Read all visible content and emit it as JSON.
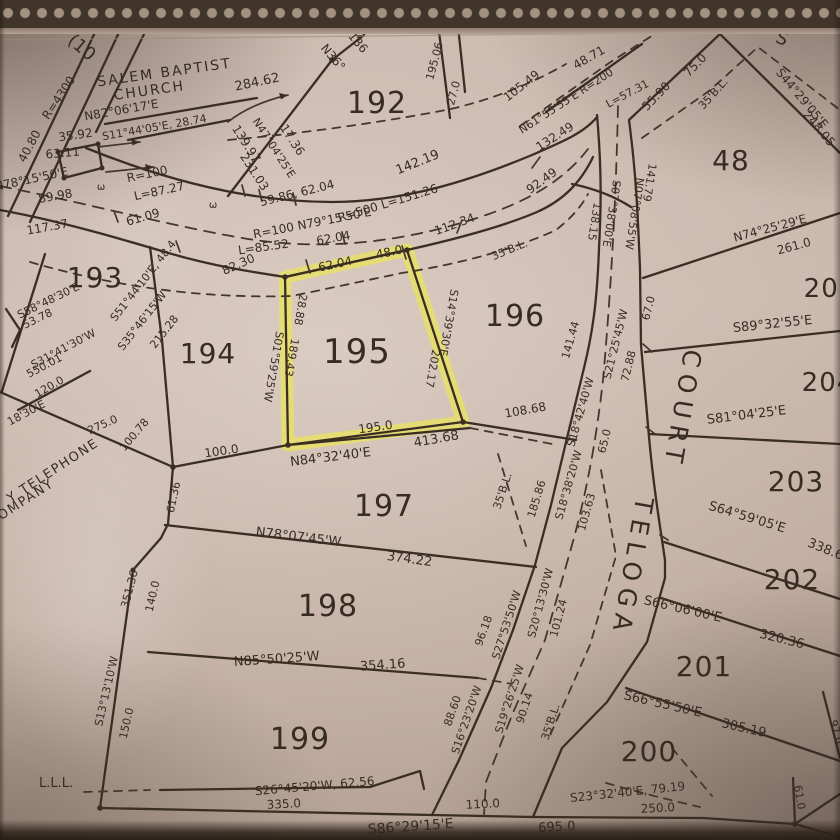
{
  "colors": {
    "ink": "#3a2e23",
    "highlight": "#e9e164",
    "paper": "#c9b6ab"
  },
  "map": {
    "street_name": "TELOGA COURT",
    "landmark": "SALEM BAPTIST CHURCH",
    "highlighted_lot": "195",
    "lot_numbers": [
      "48",
      "192",
      "193",
      "194",
      "195",
      "196",
      "197",
      "198",
      "199",
      "200",
      "201",
      "202",
      "203",
      "204",
      "205"
    ],
    "highlight_polygon": "285,277 407,250 463,422 288,445",
    "labels": [
      {
        "t": "(10",
        "x": 78,
        "y": 52,
        "r": 40,
        "s": 18
      },
      {
        "t": "R=4300",
        "x": 62,
        "y": 100,
        "r": -56,
        "s": 12
      },
      {
        "t": "SALEM BAPTIST",
        "x": 165,
        "y": 77,
        "r": -8,
        "s": 14,
        "sp": 2,
        "n": "church-label"
      },
      {
        "t": "CHURCH",
        "x": 150,
        "y": 95,
        "r": -8,
        "s": 14,
        "sp": 2,
        "n": "church-label"
      },
      {
        "t": "284.62",
        "x": 258,
        "y": 86,
        "r": -12,
        "s": 13
      },
      {
        "t": "N82°06'17'E",
        "x": 122,
        "y": 114,
        "r": -10,
        "s": 12
      },
      {
        "t": "S11°44'05'E, 28.74",
        "x": 155,
        "y": 131,
        "r": -10,
        "s": 11
      },
      {
        "t": "40.80",
        "x": 33,
        "y": 148,
        "r": -62,
        "s": 12
      },
      {
        "t": "35.92",
        "x": 76,
        "y": 139,
        "r": -8,
        "s": 12
      },
      {
        "t": "63.11",
        "x": 63,
        "y": 157,
        "r": -5,
        "s": 12
      },
      {
        "t": "N78°15'50'E",
        "x": 32,
        "y": 183,
        "r": -12,
        "s": 12
      },
      {
        "t": "89.98",
        "x": 56,
        "y": 200,
        "r": -10,
        "s": 12
      },
      {
        "t": "ω",
        "x": 101,
        "y": 190,
        "r": 0,
        "s": 10
      },
      {
        "t": "ω",
        "x": 213,
        "y": 208,
        "r": 0,
        "s": 10
      },
      {
        "t": "R=100",
        "x": 148,
        "y": 178,
        "r": -12,
        "s": 12
      },
      {
        "t": "L=87.27",
        "x": 160,
        "y": 195,
        "r": -12,
        "s": 12
      },
      {
        "t": "117.37",
        "x": 48,
        "y": 231,
        "r": -10,
        "s": 12
      },
      {
        "t": "61.09",
        "x": 144,
        "y": 221,
        "r": -16,
        "s": 12
      },
      {
        "t": "139.97",
        "x": 243,
        "y": 146,
        "r": 57,
        "s": 12
      },
      {
        "t": "N47°04'25'E",
        "x": 271,
        "y": 150,
        "r": 57,
        "s": 11
      },
      {
        "t": "231.03",
        "x": 251,
        "y": 174,
        "r": 57,
        "s": 12
      },
      {
        "t": "17.36",
        "x": 289,
        "y": 142,
        "r": 57,
        "s": 12
      },
      {
        "t": "N36°",
        "x": 330,
        "y": 60,
        "r": 50,
        "s": 12
      },
      {
        "t": "136",
        "x": 355,
        "y": 45,
        "r": 50,
        "s": 12
      },
      {
        "t": "192",
        "x": 377,
        "y": 113,
        "r": 0,
        "s": 30,
        "cls": "lot",
        "n": "lot-number-192"
      },
      {
        "t": "59.86, 62.04",
        "x": 298,
        "y": 197,
        "r": -14,
        "s": 12
      },
      {
        "t": "R=100 N79°15'50'E",
        "x": 313,
        "y": 227,
        "r": -11,
        "s": 12
      },
      {
        "t": "62.04",
        "x": 334,
        "y": 242,
        "r": -10,
        "s": 12
      },
      {
        "t": "L=85.52",
        "x": 264,
        "y": 251,
        "r": -8,
        "s": 12
      },
      {
        "t": "142.19",
        "x": 419,
        "y": 166,
        "r": -22,
        "s": 13
      },
      {
        "t": "R=500 L=151.26",
        "x": 389,
        "y": 207,
        "r": -17,
        "s": 12
      },
      {
        "t": "112.34",
        "x": 456,
        "y": 228,
        "r": -20,
        "s": 12
      },
      {
        "t": "62.04",
        "x": 336,
        "y": 268,
        "r": -12,
        "s": 12
      },
      {
        "t": "48.0",
        "x": 390,
        "y": 256,
        "r": -12,
        "s": 12
      },
      {
        "t": "82.30",
        "x": 240,
        "y": 268,
        "r": -24,
        "s": 12
      },
      {
        "t": "195.06",
        "x": 438,
        "y": 62,
        "r": -75,
        "s": 11
      },
      {
        "t": "27.0",
        "x": 457,
        "y": 94,
        "r": -75,
        "s": 11
      },
      {
        "t": "105.49",
        "x": 524,
        "y": 89,
        "r": -38,
        "s": 12
      },
      {
        "t": "48.71",
        "x": 591,
        "y": 61,
        "r": -30,
        "s": 12
      },
      {
        "t": "N61°55'55'E R=200",
        "x": 568,
        "y": 104,
        "r": -33,
        "s": 11
      },
      {
        "t": "L=57.31",
        "x": 629,
        "y": 97,
        "r": -28,
        "s": 11
      },
      {
        "t": "132.49",
        "x": 557,
        "y": 140,
        "r": -33,
        "s": 12
      },
      {
        "t": "92.49",
        "x": 544,
        "y": 184,
        "r": -36,
        "s": 12
      },
      {
        "t": "S",
        "x": 780,
        "y": 44,
        "r": 20,
        "s": 18
      },
      {
        "t": "55.90",
        "x": 659,
        "y": 99,
        "r": -46,
        "s": 12
      },
      {
        "t": "75.0",
        "x": 698,
        "y": 68,
        "r": -46,
        "s": 12
      },
      {
        "t": "35'B.L.",
        "x": 716,
        "y": 96,
        "r": -48,
        "s": 11
      },
      {
        "t": "S44°29'05'E",
        "x": 799,
        "y": 101,
        "r": 50,
        "s": 12
      },
      {
        "t": "248.05",
        "x": 816,
        "y": 131,
        "r": 50,
        "s": 12
      },
      {
        "t": "48",
        "x": 731,
        "y": 170,
        "r": 0,
        "s": 28,
        "cls": "lot",
        "n": "lot-number-48"
      },
      {
        "t": "N74°25'29'E",
        "x": 771,
        "y": 232,
        "r": -15,
        "s": 12
      },
      {
        "t": "261.0",
        "x": 795,
        "y": 250,
        "r": -15,
        "s": 12
      },
      {
        "t": "141.79",
        "x": 646,
        "y": 182,
        "r": 99,
        "s": 11
      },
      {
        "t": "N07°08'55'W",
        "x": 631,
        "y": 213,
        "r": 99,
        "s": 11
      },
      {
        "t": "138.15",
        "x": 591,
        "y": 221,
        "r": 99,
        "s": 11
      },
      {
        "t": "S07°38'00'E",
        "x": 608,
        "y": 213,
        "r": 99,
        "s": 11
      },
      {
        "t": "196",
        "x": 515,
        "y": 326,
        "r": 0,
        "s": 30,
        "cls": "lot",
        "n": "lot-number-196"
      },
      {
        "t": "35'B.L.",
        "x": 511,
        "y": 253,
        "r": -22,
        "s": 11
      },
      {
        "t": "S14°39'30'E",
        "x": 445,
        "y": 322,
        "r": 100,
        "s": 11
      },
      {
        "t": "202.17",
        "x": 429,
        "y": 368,
        "r": 100,
        "s": 11
      },
      {
        "t": "195",
        "x": 357,
        "y": 363,
        "r": 0,
        "s": 34,
        "cls": "lot",
        "n": "lot-number-195"
      },
      {
        "t": "S01°59'25'W",
        "x": 270,
        "y": 366,
        "r": 100,
        "s": 11
      },
      {
        "t": "189.43",
        "x": 288,
        "y": 357,
        "r": 100,
        "s": 11
      },
      {
        "t": "28.88",
        "x": 297,
        "y": 309,
        "r": 100,
        "s": 11
      },
      {
        "t": "195.0",
        "x": 376,
        "y": 431,
        "r": -8,
        "s": 12
      },
      {
        "t": "N84°32'40'E",
        "x": 331,
        "y": 461,
        "r": -7,
        "s": 13
      },
      {
        "t": "413.68",
        "x": 437,
        "y": 443,
        "r": -10,
        "s": 13
      },
      {
        "t": "108.68",
        "x": 526,
        "y": 414,
        "r": -10,
        "s": 12
      },
      {
        "t": "193",
        "x": 95,
        "y": 287,
        "r": 0,
        "s": 28,
        "cls": "lot",
        "n": "lot-number-193"
      },
      {
        "t": "S58°48'30'E",
        "x": 50,
        "y": 304,
        "r": -26,
        "s": 11
      },
      {
        "t": "53.78",
        "x": 39,
        "y": 322,
        "r": -26,
        "s": 11
      },
      {
        "t": "S31°41'30'W",
        "x": 65,
        "y": 352,
        "r": -28,
        "s": 11
      },
      {
        "t": "550.01",
        "x": 46,
        "y": 369,
        "r": -28,
        "s": 11
      },
      {
        "t": "120.0",
        "x": 51,
        "y": 390,
        "r": -30,
        "s": 11
      },
      {
        "t": "18'30'E",
        "x": 28,
        "y": 416,
        "r": -28,
        "s": 11
      },
      {
        "t": "275.0",
        "x": 104,
        "y": 428,
        "r": -24,
        "s": 11
      },
      {
        "t": "Y TELEPHONE",
        "x": 55,
        "y": 474,
        "r": -33,
        "s": 13,
        "sp": 1.5
      },
      {
        "t": "OMPANY",
        "x": 28,
        "y": 503,
        "r": -33,
        "s": 13,
        "sp": 1.5
      },
      {
        "t": "100.78",
        "x": 137,
        "y": 437,
        "r": -50,
        "s": 11
      },
      {
        "t": "100.0",
        "x": 222,
        "y": 455,
        "r": -8,
        "s": 12
      },
      {
        "t": "S51°44'10'E, 48.4",
        "x": 146,
        "y": 283,
        "r": -52,
        "s": 11
      },
      {
        "t": "S35°46'15'W",
        "x": 145,
        "y": 323,
        "r": -52,
        "s": 11
      },
      {
        "t": "215.28",
        "x": 167,
        "y": 334,
        "r": -52,
        "s": 11
      },
      {
        "t": "194",
        "x": 208,
        "y": 363,
        "r": 0,
        "s": 28,
        "cls": "lot",
        "n": "lot-number-194"
      },
      {
        "t": "61.36",
        "x": 177,
        "y": 498,
        "r": -78,
        "s": 11
      },
      {
        "t": "351.36",
        "x": 133,
        "y": 590,
        "r": -75,
        "s": 11
      },
      {
        "t": "140.0",
        "x": 156,
        "y": 597,
        "r": -77,
        "s": 11
      },
      {
        "t": "S13°13'10'W",
        "x": 110,
        "y": 692,
        "r": -77,
        "s": 11
      },
      {
        "t": "150.0",
        "x": 130,
        "y": 724,
        "r": -77,
        "s": 11
      },
      {
        "t": "L.L.L.",
        "x": 56,
        "y": 787,
        "r": 0,
        "s": 13
      },
      {
        "t": "197",
        "x": 384,
        "y": 516,
        "r": 0,
        "s": 30,
        "cls": "lot",
        "n": "lot-number-197"
      },
      {
        "t": "N78°07'45'W",
        "x": 298,
        "y": 541,
        "r": 7,
        "s": 13
      },
      {
        "t": "374.22",
        "x": 409,
        "y": 563,
        "r": 8,
        "s": 13
      },
      {
        "t": "198",
        "x": 328,
        "y": 616,
        "r": 0,
        "s": 30,
        "cls": "lot",
        "n": "lot-number-198"
      },
      {
        "t": "N85°50'25'W",
        "x": 277,
        "y": 663,
        "r": -4,
        "s": 13
      },
      {
        "t": "354.16",
        "x": 383,
        "y": 669,
        "r": -4,
        "s": 13
      },
      {
        "t": "199",
        "x": 300,
        "y": 749,
        "r": 0,
        "s": 30,
        "cls": "lot",
        "n": "lot-number-199"
      },
      {
        "t": "S26°45'20'W, 62.56",
        "x": 315,
        "y": 790,
        "r": -5,
        "s": 12
      },
      {
        "t": "335.0",
        "x": 284,
        "y": 808,
        "r": -3,
        "s": 12
      },
      {
        "t": "35'B.L.",
        "x": 506,
        "y": 492,
        "r": -72,
        "s": 11
      },
      {
        "t": "96.18",
        "x": 487,
        "y": 632,
        "r": -70,
        "s": 11
      },
      {
        "t": "S27°53'50'W",
        "x": 510,
        "y": 626,
        "r": -72,
        "s": 11
      },
      {
        "t": "S20°13'30'W",
        "x": 544,
        "y": 604,
        "r": -75,
        "s": 11
      },
      {
        "t": "101.24",
        "x": 562,
        "y": 619,
        "r": -75,
        "s": 11
      },
      {
        "t": "S19°26'25'W",
        "x": 513,
        "y": 700,
        "r": -72,
        "s": 11
      },
      {
        "t": "90.14",
        "x": 528,
        "y": 709,
        "r": -72,
        "s": 11
      },
      {
        "t": "S16°23'20'W",
        "x": 470,
        "y": 721,
        "r": -71,
        "s": 11
      },
      {
        "t": "88.60",
        "x": 456,
        "y": 712,
        "r": -71,
        "s": 11
      },
      {
        "t": "110.0",
        "x": 483,
        "y": 808,
        "r": -3,
        "s": 12
      },
      {
        "t": "35'B.L.",
        "x": 554,
        "y": 723,
        "r": -72,
        "s": 11
      },
      {
        "t": "185.86",
        "x": 540,
        "y": 500,
        "r": -73,
        "s": 11
      },
      {
        "t": "S18°38'20'W",
        "x": 572,
        "y": 486,
        "r": -74,
        "s": 11
      },
      {
        "t": "103.63",
        "x": 590,
        "y": 513,
        "r": -74,
        "s": 11
      },
      {
        "t": "141.44",
        "x": 574,
        "y": 341,
        "r": -74,
        "s": 11
      },
      {
        "t": "S18°42'40'W",
        "x": 584,
        "y": 413,
        "r": -74,
        "s": 11
      },
      {
        "t": "S21°25'45'W",
        "x": 619,
        "y": 345,
        "r": -76,
        "s": 11
      },
      {
        "t": "72.88",
        "x": 632,
        "y": 367,
        "r": -76,
        "s": 11
      },
      {
        "t": "67.0",
        "x": 652,
        "y": 309,
        "r": -76,
        "s": 11
      },
      {
        "t": "65.0",
        "x": 608,
        "y": 442,
        "r": -76,
        "s": 11
      },
      {
        "t": "COURT",
        "x": 674,
        "y": 408,
        "r": 100,
        "s": 25,
        "sp": 7,
        "n": "street-name"
      },
      {
        "t": "TELOGA",
        "x": 624,
        "y": 566,
        "r": 100,
        "s": 25,
        "sp": 7,
        "n": "street-name"
      },
      {
        "t": "205",
        "x": 830,
        "y": 297,
        "r": 0,
        "s": 26,
        "cls": "lot",
        "n": "lot-number-205"
      },
      {
        "t": "S89°32'55'E",
        "x": 773,
        "y": 328,
        "r": -6,
        "s": 13
      },
      {
        "t": "204",
        "x": 828,
        "y": 391,
        "r": 0,
        "s": 26,
        "cls": "lot",
        "n": "lot-number-204"
      },
      {
        "t": "S81°04'25'E",
        "x": 747,
        "y": 419,
        "r": -7,
        "s": 13
      },
      {
        "t": "203",
        "x": 796,
        "y": 491,
        "r": 0,
        "s": 28,
        "cls": "lot",
        "n": "lot-number-203"
      },
      {
        "t": "S64°59'05'E",
        "x": 746,
        "y": 521,
        "r": 17,
        "s": 13
      },
      {
        "t": "338.6",
        "x": 824,
        "y": 553,
        "r": 22,
        "s": 13
      },
      {
        "t": "202",
        "x": 792,
        "y": 589,
        "r": 0,
        "s": 28,
        "cls": "lot",
        "n": "lot-number-202"
      },
      {
        "t": "S66°06'00'E",
        "x": 682,
        "y": 613,
        "r": 13,
        "s": 13
      },
      {
        "t": "320.36",
        "x": 781,
        "y": 643,
        "r": 14,
        "s": 13
      },
      {
        "t": "201",
        "x": 704,
        "y": 676,
        "r": 0,
        "s": 28,
        "cls": "lot",
        "n": "lot-number-201"
      },
      {
        "t": "S66°55'50'E",
        "x": 662,
        "y": 708,
        "r": 13,
        "s": 13
      },
      {
        "t": "305.19",
        "x": 743,
        "y": 732,
        "r": 13,
        "s": 13
      },
      {
        "t": "200",
        "x": 649,
        "y": 761,
        "r": 0,
        "s": 28,
        "cls": "lot",
        "n": "lot-number-200"
      },
      {
        "t": "S23°32'40'E, 79.19",
        "x": 628,
        "y": 796,
        "r": -6,
        "s": 12
      },
      {
        "t": "250.0",
        "x": 658,
        "y": 812,
        "r": -3,
        "s": 12
      },
      {
        "t": "695.0",
        "x": 557,
        "y": 831,
        "r": -3,
        "s": 13
      },
      {
        "t": "S86°29'15'E",
        "x": 411,
        "y": 831,
        "r": -4,
        "s": 14
      },
      {
        "t": "61.0",
        "x": 796,
        "y": 798,
        "r": 80,
        "s": 11
      },
      {
        "t": "97.0",
        "x": 833,
        "y": 733,
        "r": 72,
        "s": 11
      }
    ]
  }
}
